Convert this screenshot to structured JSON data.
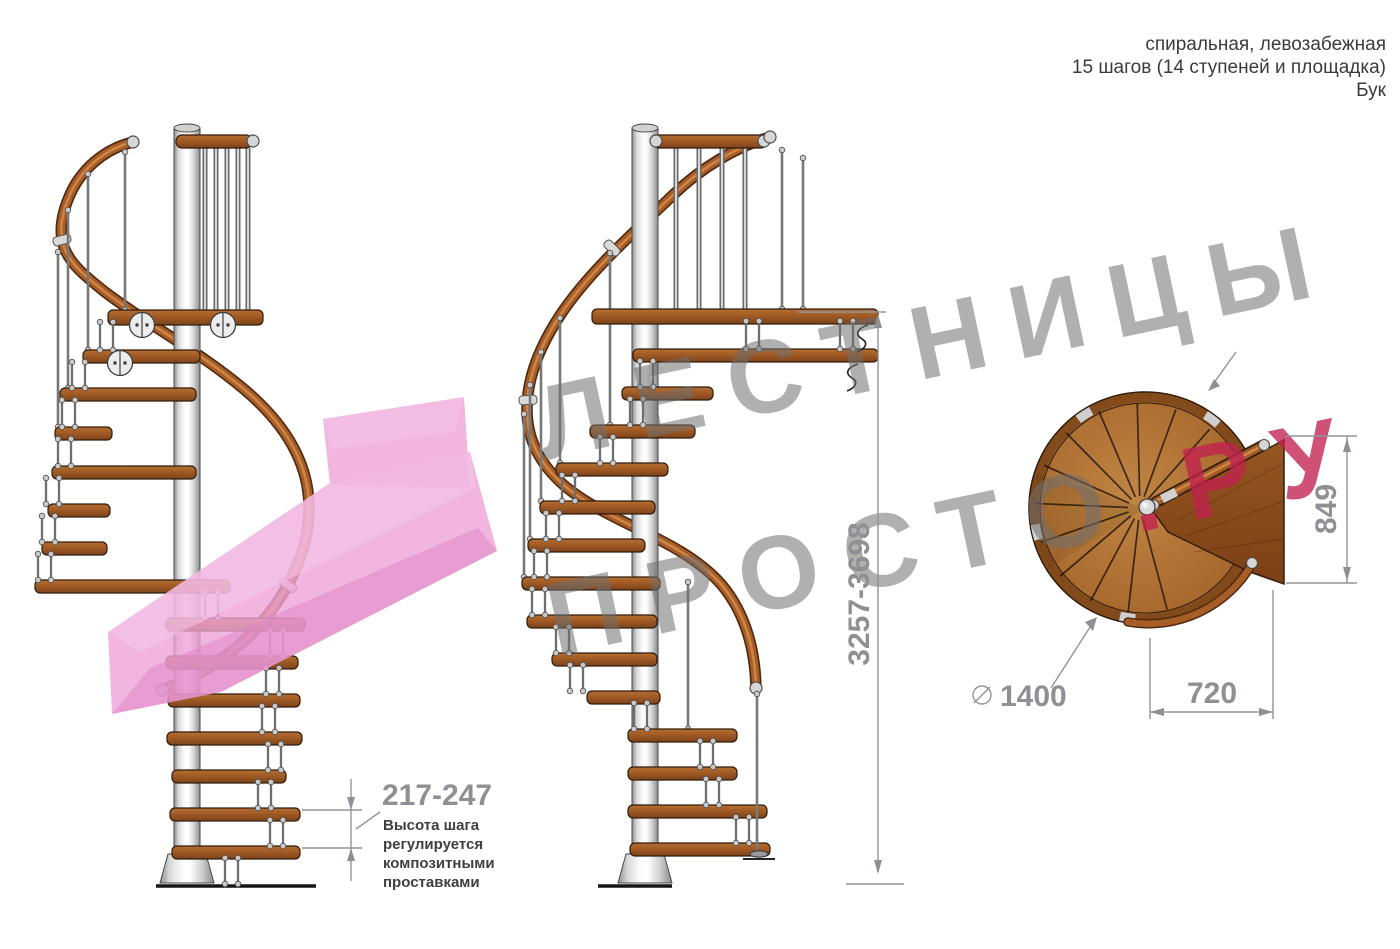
{
  "header": {
    "type_line": "спиральная, левозабежная",
    "steps_line": "15 шагов (14 ступеней и площадка)",
    "material_line": "Бук"
  },
  "watermark": {
    "line1": "ЛЕСТНИЦЫ",
    "line2_main": "ПРОСТО",
    "line2_accent": ".РУ"
  },
  "dimensions": {
    "total_height": "3257-3698",
    "step_height": "217-247",
    "platform_side": "849",
    "platform_offset": "720",
    "diameter": "1400",
    "diameter_symbol": "⌀"
  },
  "step_note": {
    "lines": [
      "Высота шага",
      "регулируется",
      "композитными",
      "проставками"
    ]
  },
  "colors": {
    "wood": "#a85c26",
    "metal_pole": "#d9d9d9",
    "dimension_gray": "#8d9196",
    "watermark_gray": "#b0b0b0",
    "watermark_accent": "#cd4d73",
    "arrow_pink": "#eda3d7"
  }
}
